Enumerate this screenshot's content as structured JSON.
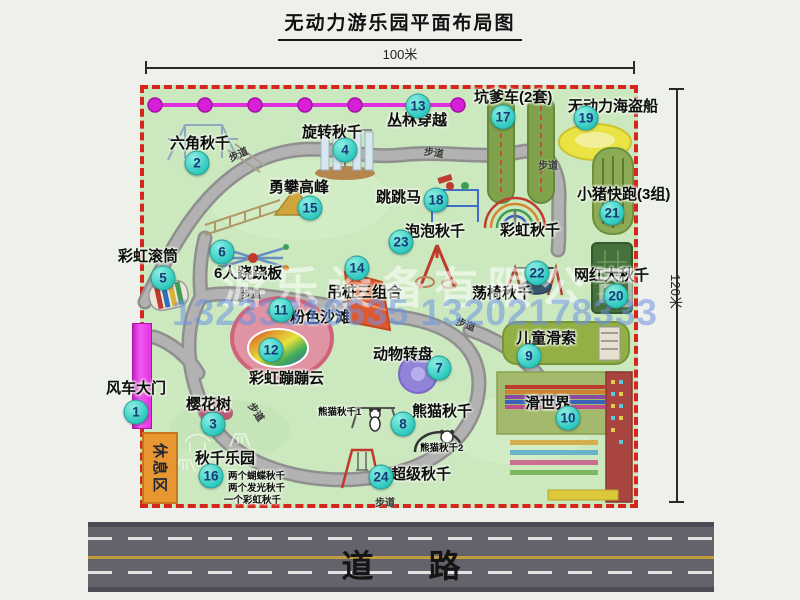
{
  "title": "无动力游乐园平面布局图",
  "dimensions": {
    "top": "100米",
    "right": "120米"
  },
  "road_label": "道 路",
  "path_label": "步道",
  "rest_area_label": "休息区",
  "rainbow_swing_label": "彩虹秋千",
  "watermark": {
    "company": "游乐设备有限公司",
    "phone": "13233816635 13202178333"
  },
  "colors": {
    "marker_teal": "#2cc8bd",
    "boundary_red": "#d5251c",
    "park_green": "#cbe8bf",
    "gate_magenta": "#e332e3",
    "road_gray": "#63636c",
    "rest_orange": "#e8962f"
  },
  "attractions": [
    {
      "num": "1",
      "name": "风车大门"
    },
    {
      "num": "2",
      "name": "六角秋千"
    },
    {
      "num": "3",
      "name": "樱花树"
    },
    {
      "num": "4",
      "name": "旋转秋千"
    },
    {
      "num": "5",
      "name": "彩虹滚筒"
    },
    {
      "num": "6",
      "name": "6人跷跷板"
    },
    {
      "num": "7",
      "name": "动物转盘"
    },
    {
      "num": "8",
      "name": "熊猫秋千",
      "subs": [
        "熊猫秋千1",
        "熊猫秋千2"
      ]
    },
    {
      "num": "9",
      "name": "儿童滑索"
    },
    {
      "num": "10",
      "name": "滑世界"
    },
    {
      "num": "11",
      "name": "粉色沙滩"
    },
    {
      "num": "12",
      "name": "彩虹蹦蹦云"
    },
    {
      "num": "13",
      "name": "丛林穿越"
    },
    {
      "num": "14",
      "name": "吊桩三组合"
    },
    {
      "num": "15",
      "name": "勇攀高峰"
    },
    {
      "num": "16",
      "name": "秋千乐园",
      "subs": [
        "两个蝴蝶秋千",
        "两个发光秋千",
        "一个彩虹秋千"
      ]
    },
    {
      "num": "17",
      "name": "坑爹车(2套)"
    },
    {
      "num": "18",
      "name": "跳跳马"
    },
    {
      "num": "19",
      "name": "无动力海盗船"
    },
    {
      "num": "20",
      "name": "网红大秋千"
    },
    {
      "num": "21",
      "name": "小猪快跑(3组)"
    },
    {
      "num": "22",
      "name": "荡椅秋千"
    },
    {
      "num": "23",
      "name": "泡泡秋千"
    },
    {
      "num": "24",
      "name": "超级秋千"
    }
  ]
}
